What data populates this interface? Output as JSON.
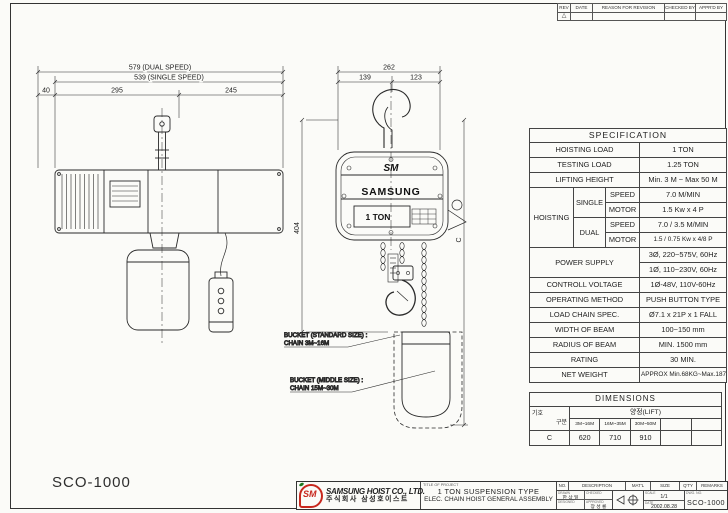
{
  "revision": {
    "headers": [
      "REV",
      "DATE",
      "REASON FOR REVISION",
      "CHECKED BY",
      "APPR'D BY"
    ],
    "rev_mark": "△"
  },
  "drawing": {
    "model": "SCO-1000",
    "side_view": {
      "dim_dual": "579 (DUAL SPEED)",
      "dim_single": "539 (SINGLE SPEED)",
      "dim_40": "40",
      "dim_295": "295",
      "dim_245": "245"
    },
    "front_view": {
      "dim_262": "262",
      "dim_139": "139",
      "dim_123": "123",
      "dim_404": "404",
      "dim_c": "C",
      "brand_sm": "SM",
      "brand_name": "SAMSUNG",
      "capacity": "1 TON"
    },
    "notes": {
      "bucket_standard_1": "BUCKET (STANDARD SIZE) :",
      "bucket_standard_2": "CHAIN 3M~16M",
      "bucket_middle_1": "BUCKET (MIDDLE SIZE) :",
      "bucket_middle_2": "CHAIN 15M~30M"
    }
  },
  "spec": {
    "title": "SPECIFICATION",
    "rows": {
      "hoisting_load": {
        "label": "HOISTING LOAD",
        "value": "1  TON"
      },
      "testing_load": {
        "label": "TESTING LOAD",
        "value": "1.25  TON"
      },
      "lifting_height": {
        "label": "LIFTING HEIGHT",
        "value": "Min. 3 M ~ Max 50 M"
      },
      "hoisting": {
        "label": "HOISTING",
        "single": {
          "label": "SINGLE",
          "speed_label": "SPEED",
          "speed_value": "7.0  M/MIN",
          "motor_label": "MOTOR",
          "motor_value": "1.5 Kw x 4 P"
        },
        "dual": {
          "label": "DUAL",
          "speed_label": "SPEED",
          "speed_value": "7.0 / 3.5  M/MIN",
          "motor_label": "MOTOR",
          "motor_value": "1.5 / 0.75 Kw x 4/8 P"
        }
      },
      "power_supply": {
        "label": "POWER SUPPLY",
        "value_3ph": "3Ø, 220~575V, 60Hz",
        "value_1ph": "1Ø, 110~230V, 60Hz"
      },
      "control_voltage": {
        "label": "CONTROLL VOLTAGE",
        "value": "1Ø-48V, 110V-60Hz"
      },
      "operating_method": {
        "label": "OPERATING METHOD",
        "value": "PUSH BUTTON TYPE"
      },
      "load_chain": {
        "label": "LOAD CHAIN SPEC.",
        "value": "Ø7.1 x 21P x 1 FALL"
      },
      "beam_width": {
        "label": "WIDTH OF BEAM",
        "value": "100~150 mm"
      },
      "beam_radius": {
        "label": "RADIUS OF BEAM",
        "value": "MIN. 1500 mm"
      },
      "rating": {
        "label": "RATING",
        "value": "30 MIN."
      },
      "net_weight": {
        "label": "NET WEIGHT",
        "value": "APPROX  Min.68KG~Max.187KG"
      }
    }
  },
  "dimensions_table": {
    "title": "DIMENSIONS",
    "corner_top": "구분",
    "corner_bottom": "기호",
    "lift_header": "양정(LIFT)",
    "ranges": [
      "3M~16M",
      "16M~35M",
      "30M~50M",
      "",
      ""
    ],
    "symbol": "C",
    "values": [
      "620",
      "710",
      "910",
      "",
      ""
    ]
  },
  "title_block": {
    "logo_text": "SM",
    "company_en": "SAMSUNG HOIST CO., LTD.",
    "company_kr": "주식회사 삼성호이스트",
    "project_label": "TITLE OF PROJECT",
    "project_line1": "1 TON SUSPENSION TYPE",
    "project_line2": "ELEC. CHAIN HOIST GENERAL ASSEMBLY",
    "parts_headers": [
      "NO.",
      "DESCRIPTION",
      "MAT'L",
      "SIZE",
      "Q'TY",
      "REMARKS"
    ],
    "staff": {
      "drawn_label": "DRAWN",
      "drawn_name": "한 상 일",
      "checked_label": "CHECKED",
      "checked_name": "",
      "designed_label": "DESIGNED",
      "designed_name": "",
      "approved_label": "APPROVED",
      "approved_name": "장 성 룡"
    },
    "scale_label": "SCALE",
    "scale_value": "1/1",
    "date_label": "DATE",
    "date_value": "2002.08.28",
    "dwg_label": "DWG. NO.",
    "dwg_value": "SCO-1000"
  }
}
